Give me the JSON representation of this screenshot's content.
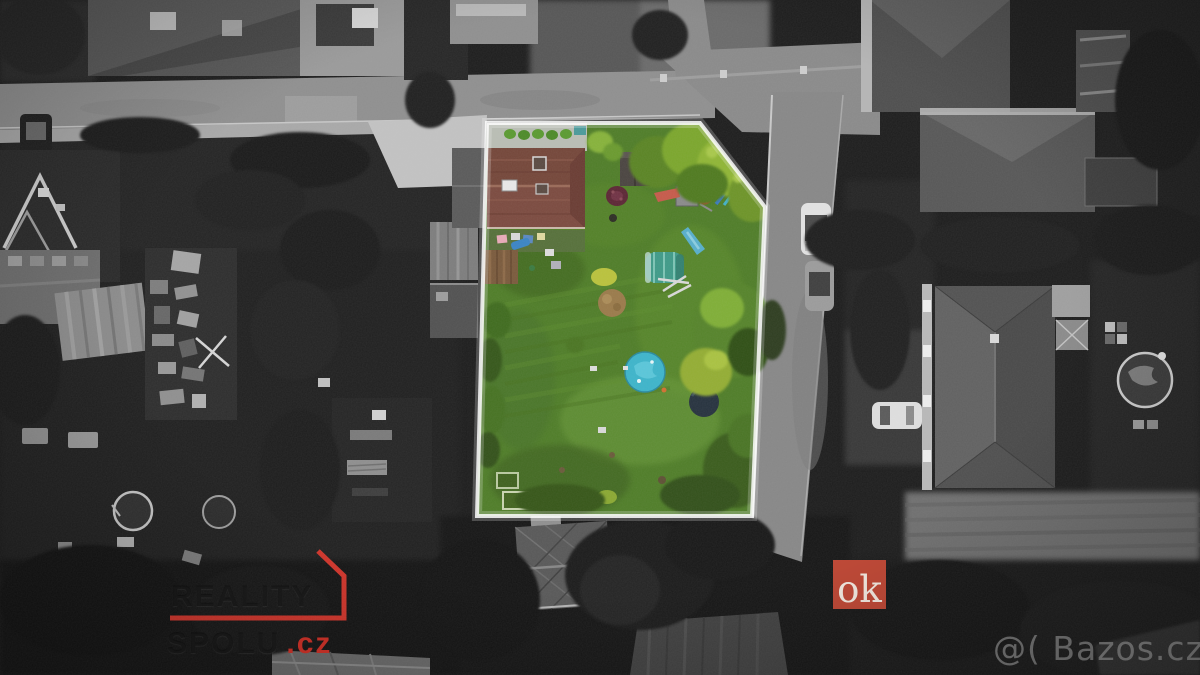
{
  "scene": {
    "description": "Aerial drone photo: color-highlighted garden plot with pool, surroundings desaturated to grayscale",
    "colors": {
      "highlight_outline": "#ffffff",
      "lawn": "#4f7d28",
      "pool": "#3db4ca",
      "trampoline": "#26323e",
      "greenhouse": "#3f9a88",
      "house_roof": "#7b4a3f",
      "accent_red": "#d2342a",
      "ok_badge_bg": "#bf4a38",
      "bazos_text": "#cdcdcd"
    }
  },
  "watermarks": {
    "brand": {
      "line1": "REALITY",
      "line2": "SPOLU",
      "tld": ".cz"
    },
    "ok": {
      "label": "ok"
    },
    "bazos": {
      "text": "@( Bazos.cz"
    }
  }
}
